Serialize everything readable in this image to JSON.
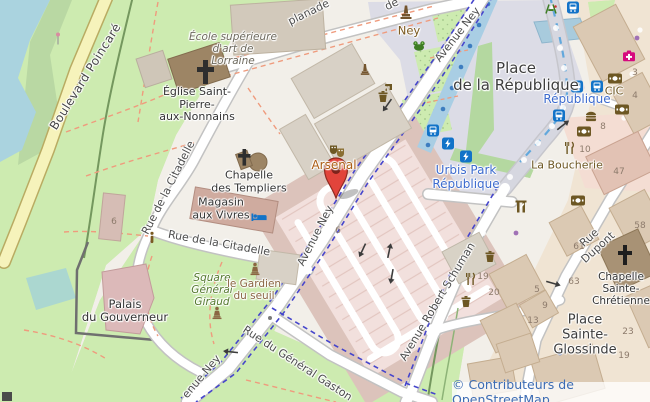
{
  "map": {
    "streets": {
      "boulevard_poincare": "Boulevard Poincaré",
      "esplanade_frag1": "de",
      "esplanade_frag2": "planade",
      "avenue_ney": "Avenue Ney",
      "avenue_ney_partial": "enue Ney",
      "rue_citadelle": "Rue de la Citadelle",
      "rue_general_gaston": "Rue du Général Gaston",
      "avenue_robert_schuman": "Avenue Robert Schuman",
      "rue_dupont": "Rue Dupont"
    },
    "places": {
      "place_republique": "Place\nde la République",
      "place_sainte_glossinde": "Place\nSainte-\nGlossinde",
      "square_general_giraud": "Square\nGénéral\nGiraud",
      "palais_gouverneur": "Palais\ndu Gouverneur"
    },
    "pois": {
      "ecole": "École supérieure\nd'art de\nLorraine",
      "eglise": "Église Saint-\nPierre-\naux-Nonnains",
      "chapelle_templiers": "Chapelle\ndes Templiers",
      "magasin_vivres": "Magasin\naux Vivres",
      "arsenal": "Arsenal",
      "ney": "Ney",
      "urbis_park": "Urbis Park\nRépublique",
      "republique_stop": "République",
      "cic": "CIC",
      "la_boucherie": "La Boucherie",
      "gardien_du_seuil": "le Gardien\ndu seuil",
      "chapelle_ste_chretienne": "Chapelle\nSainte-\nChrétienne"
    },
    "housenumbers": [
      {
        "text": "3"
      },
      {
        "text": "4"
      },
      {
        "text": "8"
      },
      {
        "text": "10"
      },
      {
        "text": "47"
      },
      {
        "text": "58"
      },
      {
        "text": "61"
      },
      {
        "text": "63"
      },
      {
        "text": "19"
      },
      {
        "text": "20"
      },
      {
        "text": "5"
      },
      {
        "text": "9"
      },
      {
        "text": "13"
      },
      {
        "text": "23"
      },
      {
        "text": "19"
      },
      {
        "text": "6"
      },
      {
        "text": "6"
      }
    ],
    "attribution": "© Contributeurs de OpenStreetMap",
    "colors": {
      "marker": "#e2443b",
      "water": "#aad3df",
      "park": "#cdebb0",
      "busway": "#a9cee4",
      "transit_blue": "#1273c8",
      "label_blue": "#3d6bce",
      "poi_brown": "#7c5a20",
      "cycle_dash": "#4545cc",
      "attribution_blue": "#3c6cb4"
    }
  }
}
